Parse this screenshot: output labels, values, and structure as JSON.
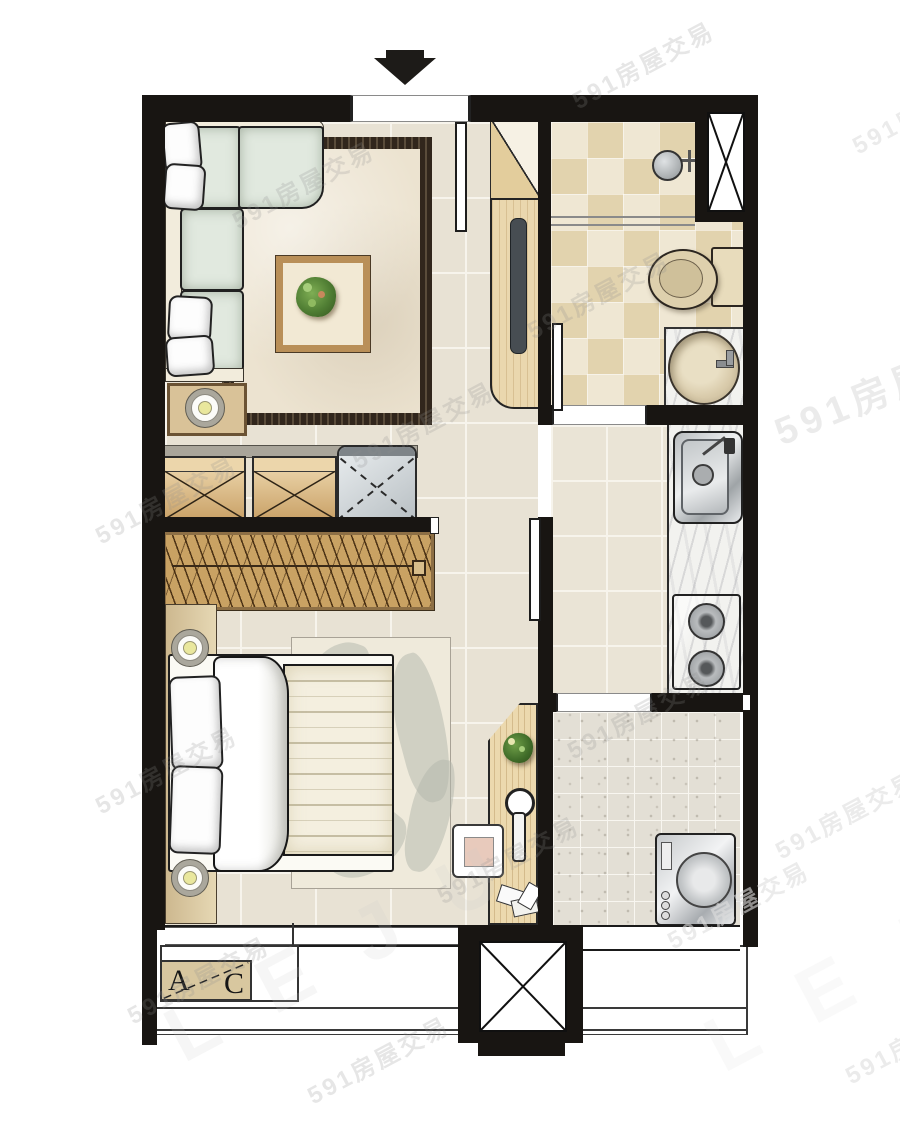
{
  "labels": {
    "ac_a": "A",
    "ac_b": "C"
  },
  "watermark": {
    "text": "591房屋交易",
    "brand": "LEJU"
  },
  "plan": {
    "type": "apartment-floor-plan",
    "orientation_marker": "entrance-arrow-top",
    "rooms_visible": [
      "living-room",
      "bathroom",
      "kitchen",
      "bedroom",
      "laundry-balcony",
      "elevator-shaft",
      "ac-platform"
    ]
  },
  "colors": {
    "wall": "#181512",
    "floor_tile": "#e8e2d4",
    "floor_grid": "#f7f4ec",
    "bath_tile": "#efe7d3",
    "bath_tile_alt": "#e2d3ae",
    "kitchen_floor": "#eae4d6",
    "laundry_floor": "#e3dfd5",
    "marble_counter": "#f2f2ef",
    "stainless": "#d4d7d9",
    "wood_light": "#ead7ae",
    "wood_mid": "#c9a265",
    "wood_dark": "#8d6f45",
    "sofa_cushion": "#e1e9df",
    "sofa_frame_cream": "#f2ecdc",
    "rug_border": "#31261c",
    "rug_field": "#ece3d0",
    "bed_blanket": "#f4efdf",
    "plant_green": "#4f7d33",
    "ac_box_tan": "#d8c79f",
    "tv_screen": "#474d52"
  }
}
